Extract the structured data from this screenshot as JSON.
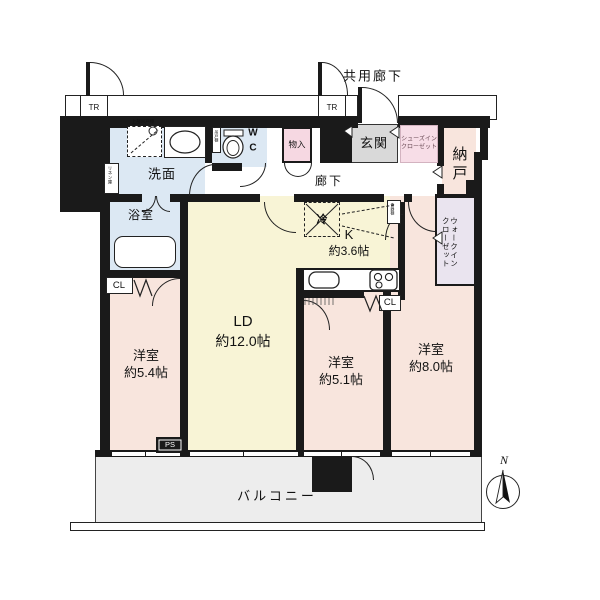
{
  "plan": {
    "common_corridor": "共用廊下",
    "trunk_room": "TR",
    "hallway": "廊下",
    "balcony": "バルコニー",
    "compass_north": "N",
    "rooms": {
      "living_dining": {
        "name": "LD",
        "size": "約12.0帖"
      },
      "kitchen": {
        "name": "K",
        "size": "約3.6帖"
      },
      "bedroom_small": {
        "name": "洋室",
        "size": "約5.4帖"
      },
      "bedroom_mid": {
        "name": "洋室",
        "size": "約5.1帖"
      },
      "bedroom_large": {
        "name": "洋室",
        "size": "約8.0帖"
      },
      "entrance": "玄関",
      "washroom": "洗面",
      "bathroom": "浴室",
      "toilet": [
        "W",
        "C"
      ],
      "storage_room": "納戸"
    },
    "closets": {
      "shoes_in_closet": [
        "シューズイン",
        "クローゼット"
      ],
      "walk_in_closet": [
        "ウォークイン",
        "クローゼット"
      ],
      "closet": "CL",
      "hall_storage": "物入",
      "linen": "リネン庫",
      "upper_cabinet": "上部吊戸棚",
      "wc_cabinet": "吊戸棚",
      "cupboard": "食器棚"
    },
    "fixtures": {
      "refrigerator": "冷",
      "pipe_space": "PS"
    },
    "colors": {
      "wall": "#1a1a1a",
      "water_rooms": "#dce8f3",
      "living_kitchen": "#f8f4d6",
      "bedroom": "#f8e5dd",
      "entrance": "#d9d9d9",
      "closet_box": "#eae4ef",
      "hall_storage_box": "#f6d8e2",
      "balcony": "#ededed"
    }
  }
}
